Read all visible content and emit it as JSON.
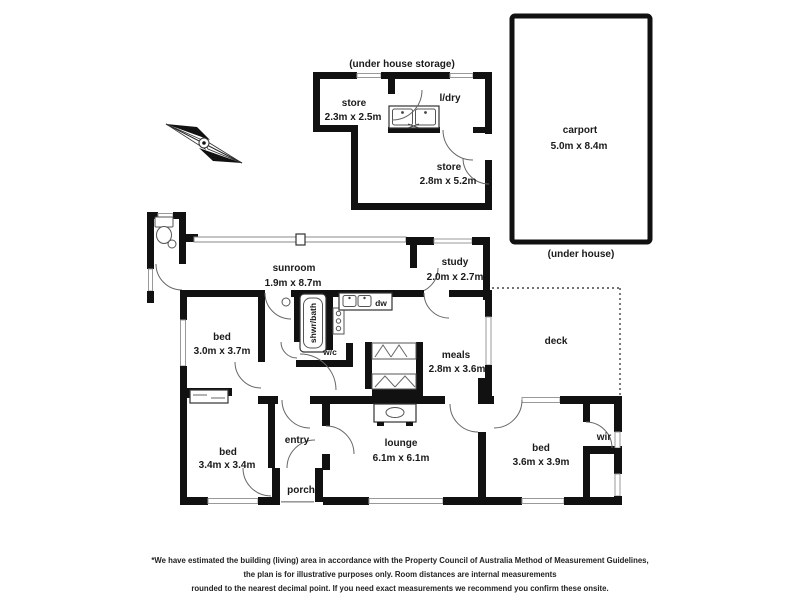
{
  "storage": {
    "header": "(under house storage)",
    "store1": {
      "label": "store",
      "dims": "2.3m x 2.5m"
    },
    "laundry": {
      "label": "l/dry"
    },
    "store2": {
      "label": "store",
      "dims": "2.8m x 5.2m"
    }
  },
  "carport": {
    "label": "carport",
    "dims": "5.0m x 8.4m",
    "note": "(under house)"
  },
  "rooms": {
    "sunroom": {
      "label": "sunroom",
      "dims": "1.9m x 8.7m"
    },
    "study": {
      "label": "study",
      "dims": "2.0m x 2.7m"
    },
    "bed1": {
      "label": "bed",
      "dims": "3.0m x 3.7m"
    },
    "meals": {
      "label": "meals",
      "dims": "2.8m x 3.6m"
    },
    "deck": {
      "label": "deck"
    },
    "bed2": {
      "label": "bed",
      "dims": "3.4m x 3.4m"
    },
    "entry": {
      "label": "entry"
    },
    "lounge": {
      "label": "lounge",
      "dims": "6.1m x 6.1m"
    },
    "porch": {
      "label": "porch"
    },
    "bed3": {
      "label": "bed",
      "dims": "3.6m x 3.9m"
    },
    "wir": {
      "label": "wir"
    },
    "bath": {
      "label": "shwr/bath"
    },
    "wc": {
      "label": "w/c"
    },
    "dw": {
      "label": "dw"
    }
  },
  "colors": {
    "wall": "#111111",
    "window_frame": "#999999",
    "text": "#1a1a1a"
  },
  "footer": {
    "line1": "*We have estimated the building (living) area in accordance with the Property Council of Australia Method of Measurement Guidelines,",
    "line2": "the plan is for illustrative purposes only. Room distances are internal measurements",
    "line3": "rounded to the nearest decimal point. If you need exact measurements we recommend you confirm these onsite."
  }
}
